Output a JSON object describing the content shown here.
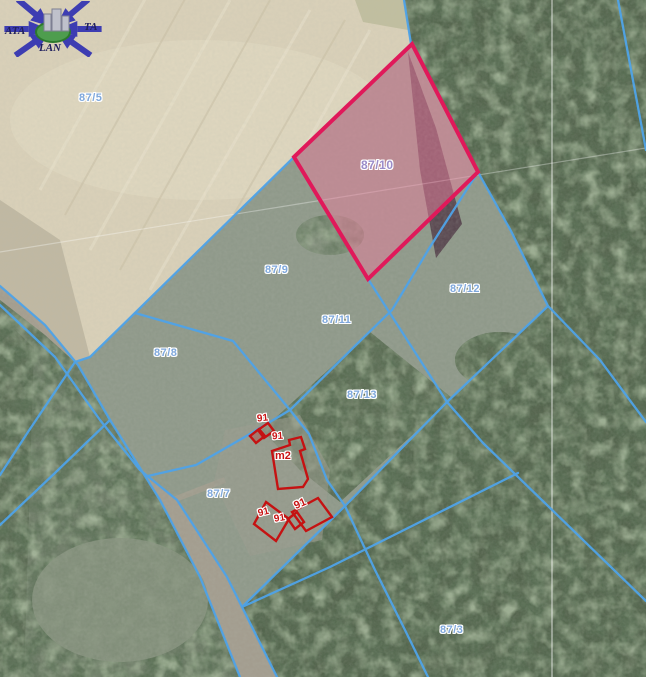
{
  "map": {
    "selected_parcel": {
      "label": "87/10"
    },
    "parcel_labels": [
      {
        "text": "87/5"
      },
      {
        "text": "87/10"
      },
      {
        "text": "87/9"
      },
      {
        "text": "87/12"
      },
      {
        "text": "87/11"
      },
      {
        "text": "87/8"
      },
      {
        "text": "87/13"
      },
      {
        "text": "87/7"
      },
      {
        "text": "87/3"
      }
    ],
    "building_labels": [
      {
        "text": "91"
      },
      {
        "text": "91"
      },
      {
        "text": "m2"
      },
      {
        "text": "91"
      },
      {
        "text": "91"
      },
      {
        "text": "91"
      }
    ]
  },
  "logo": {
    "left": "ATA",
    "right": "TA",
    "bottom": "LAN"
  },
  "colors": {
    "boundary_blue": "#4fa3e8",
    "highlight_stroke": "#e0195a",
    "highlight_fill": "rgba(231,126,155,0.5)",
    "building_red": "#c51212",
    "label_blue": "#7fa8dc",
    "label_violet": "#9b8cc9",
    "label_red": "#c81414",
    "field_beige": "#d9d0b8",
    "forest_green": "#53634c"
  }
}
